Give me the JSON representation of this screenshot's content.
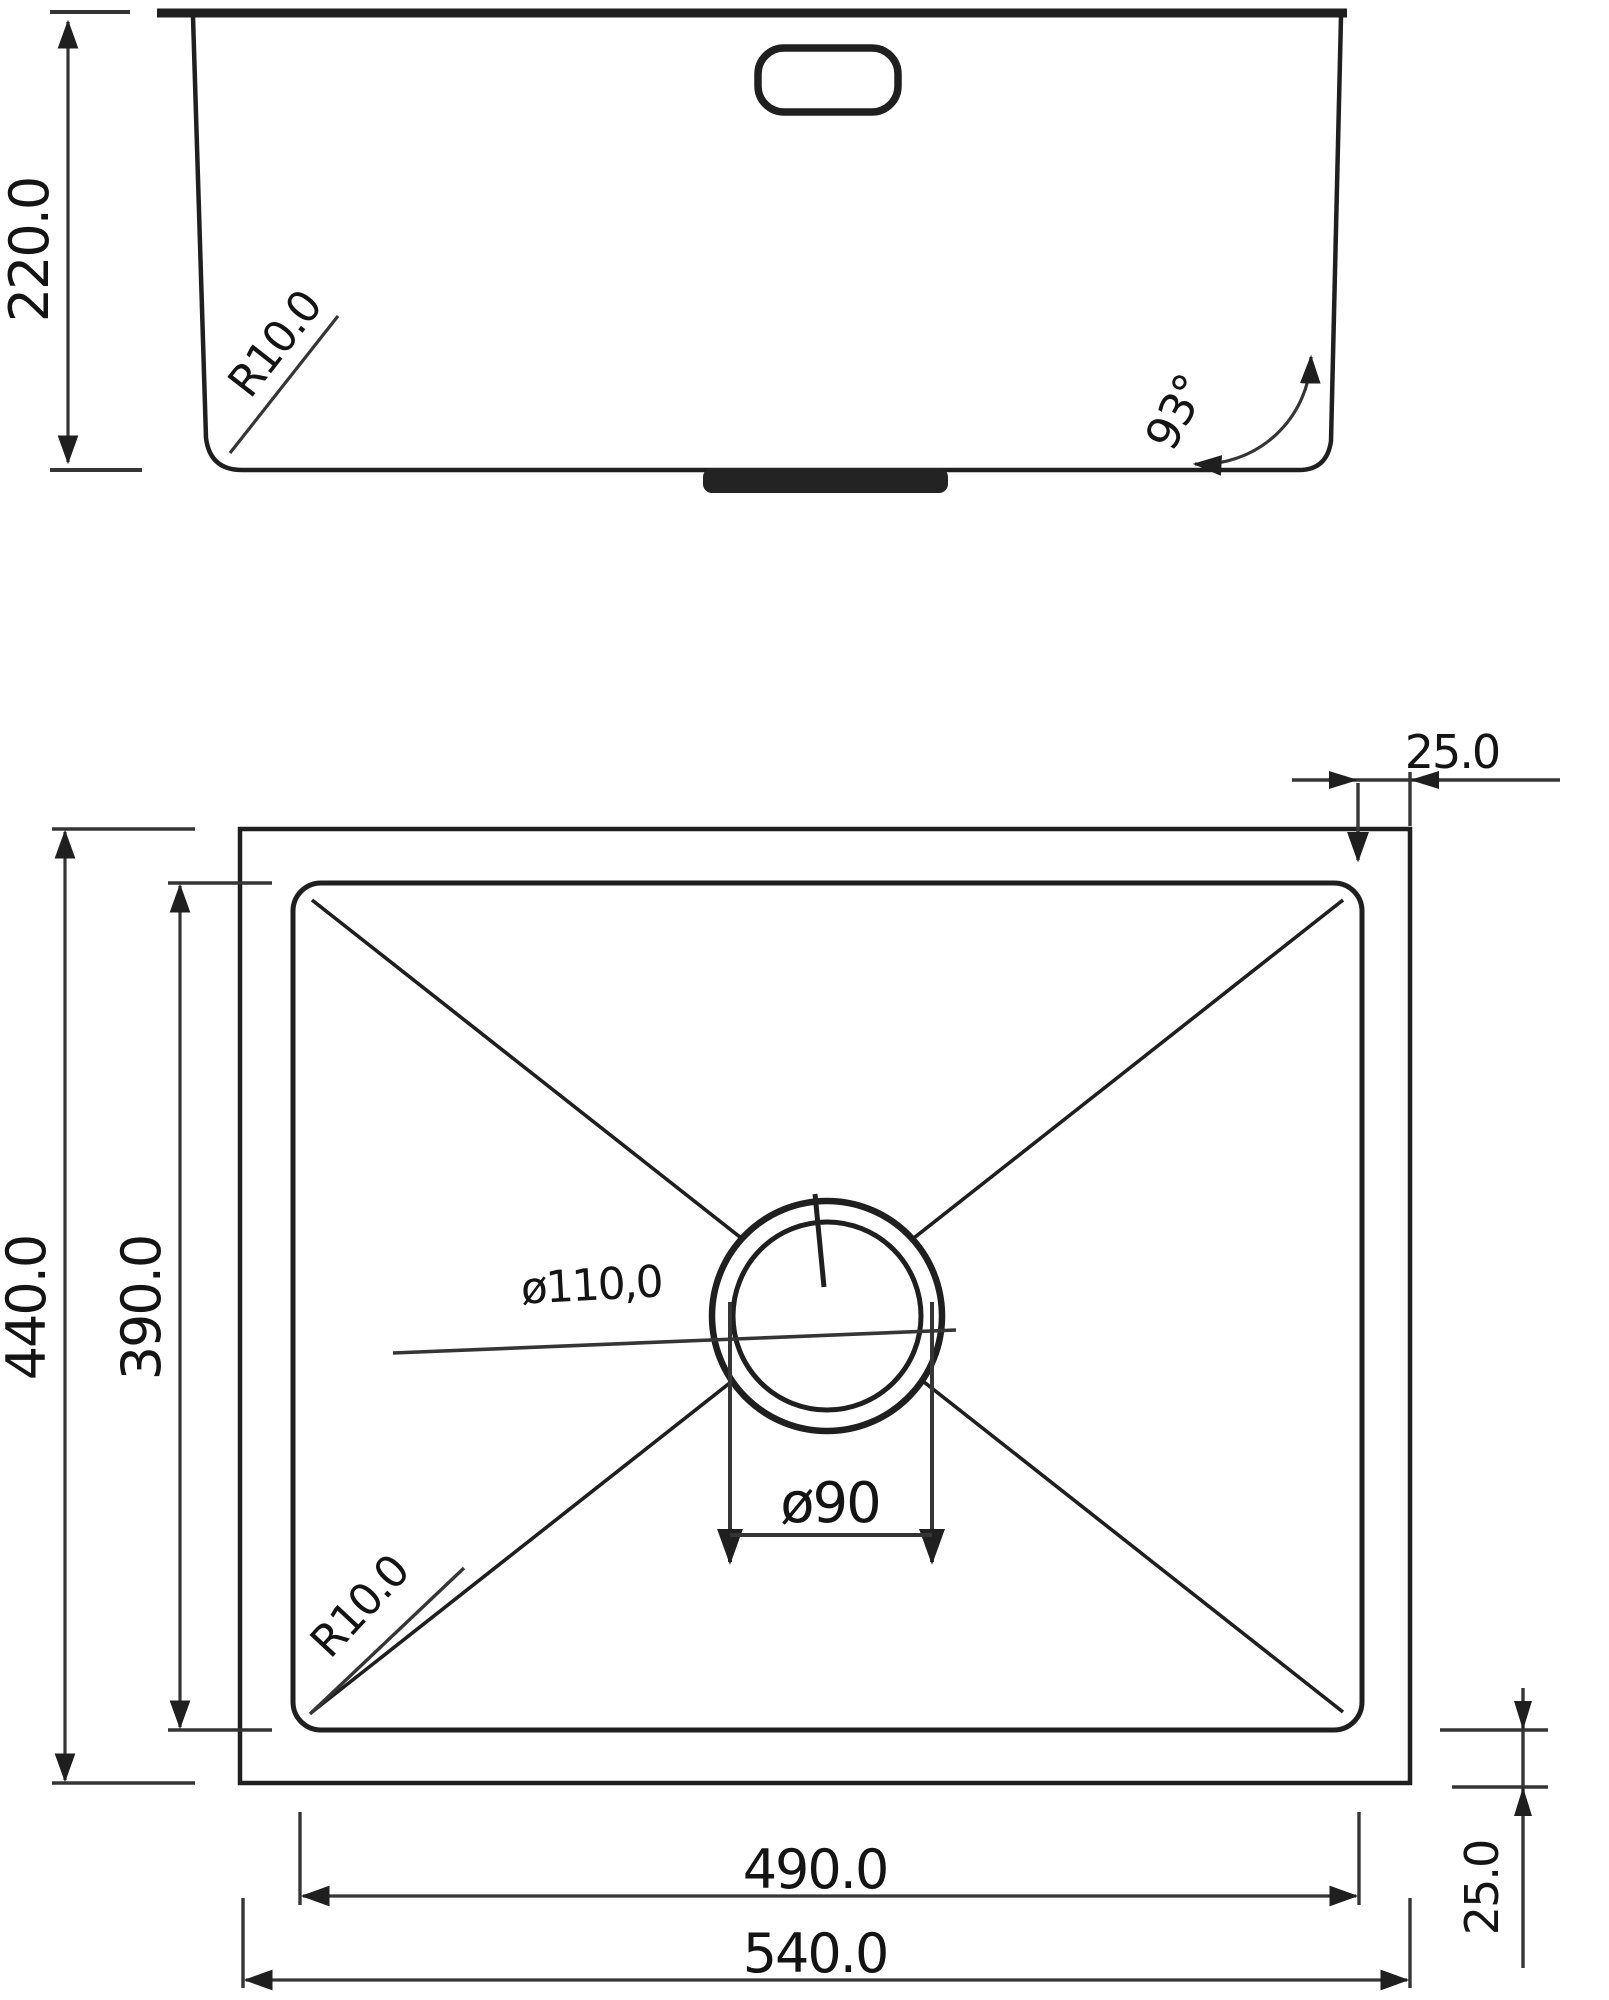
{
  "drawing_type": "sink-technical-drawing",
  "colors": {
    "line": "#1f1f1f",
    "dimension_line": "#353535",
    "text": "#141414",
    "background": "#ffffff"
  },
  "side_view": {
    "depth": "220.0",
    "corner_radius": "R10.0",
    "wall_angle": "93°"
  },
  "plan_view": {
    "outer_width": "540.0",
    "inner_width": "490.0",
    "outer_height": "440.0",
    "inner_height": "390.0",
    "rim_width_top": "25.0",
    "rim_width_side": "25.0",
    "drain_outer_diameter": "ø110,0",
    "drain_inner_diameter": "ø90",
    "corner_radius": "R10.0"
  }
}
